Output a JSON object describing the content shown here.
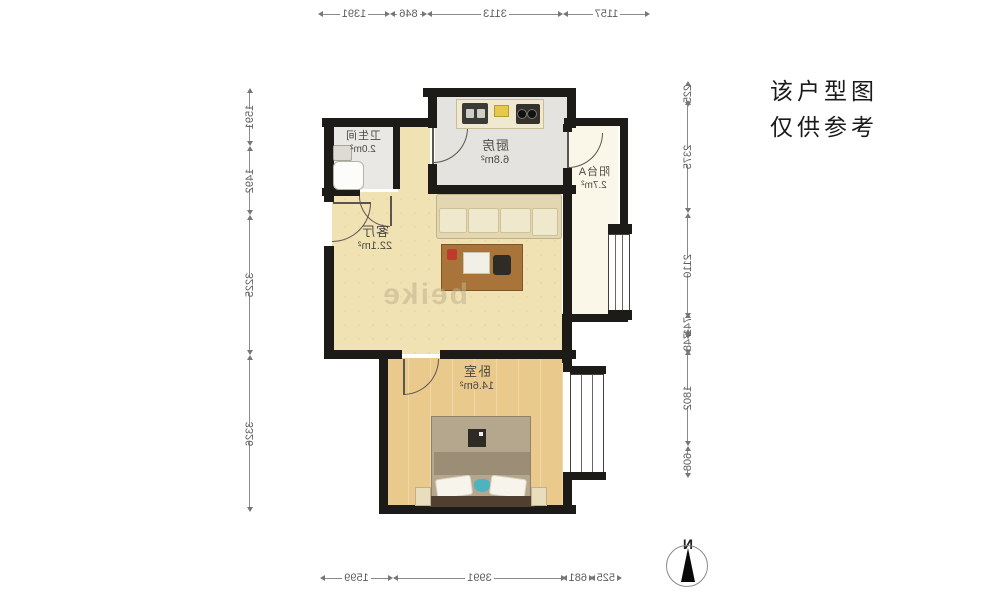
{
  "notice": {
    "line1": "该户型图",
    "line2": "仅供参考"
  },
  "rooms": {
    "kitchen": {
      "name": "厨房",
      "area": "6.8m²"
    },
    "bathroom": {
      "name": "卫生间",
      "area": "2.0m²"
    },
    "balcony": {
      "name": "阳台A",
      "area": "2.7m²"
    },
    "living": {
      "name": "客厅",
      "area": "22.1m²"
    },
    "bedroom": {
      "name": "卧室",
      "area": "14.6m²"
    }
  },
  "dims": {
    "top": [
      "1157",
      "3113",
      "846",
      "1391"
    ],
    "bottom": [
      "525",
      "681",
      "3991",
      "1599"
    ],
    "left": [
      "225",
      "2375",
      "2110",
      "741",
      "748",
      "1802",
      "608"
    ],
    "right": [
      "1591",
      "1492",
      "3225",
      "3326"
    ]
  },
  "compass": {
    "label": "N"
  },
  "watermark": "beike",
  "colors": {
    "wall": "#1d1b18",
    "living_floor": "#f1e2b4",
    "bedroom_floor": "#e9c98c",
    "kitchen_floor": "#e4e3df",
    "bathroom_floor": "#e9e8e4",
    "balcony_floor": "#fbf7e8",
    "accent_red": "#c0392b",
    "accent_teal": "#4db3be"
  }
}
